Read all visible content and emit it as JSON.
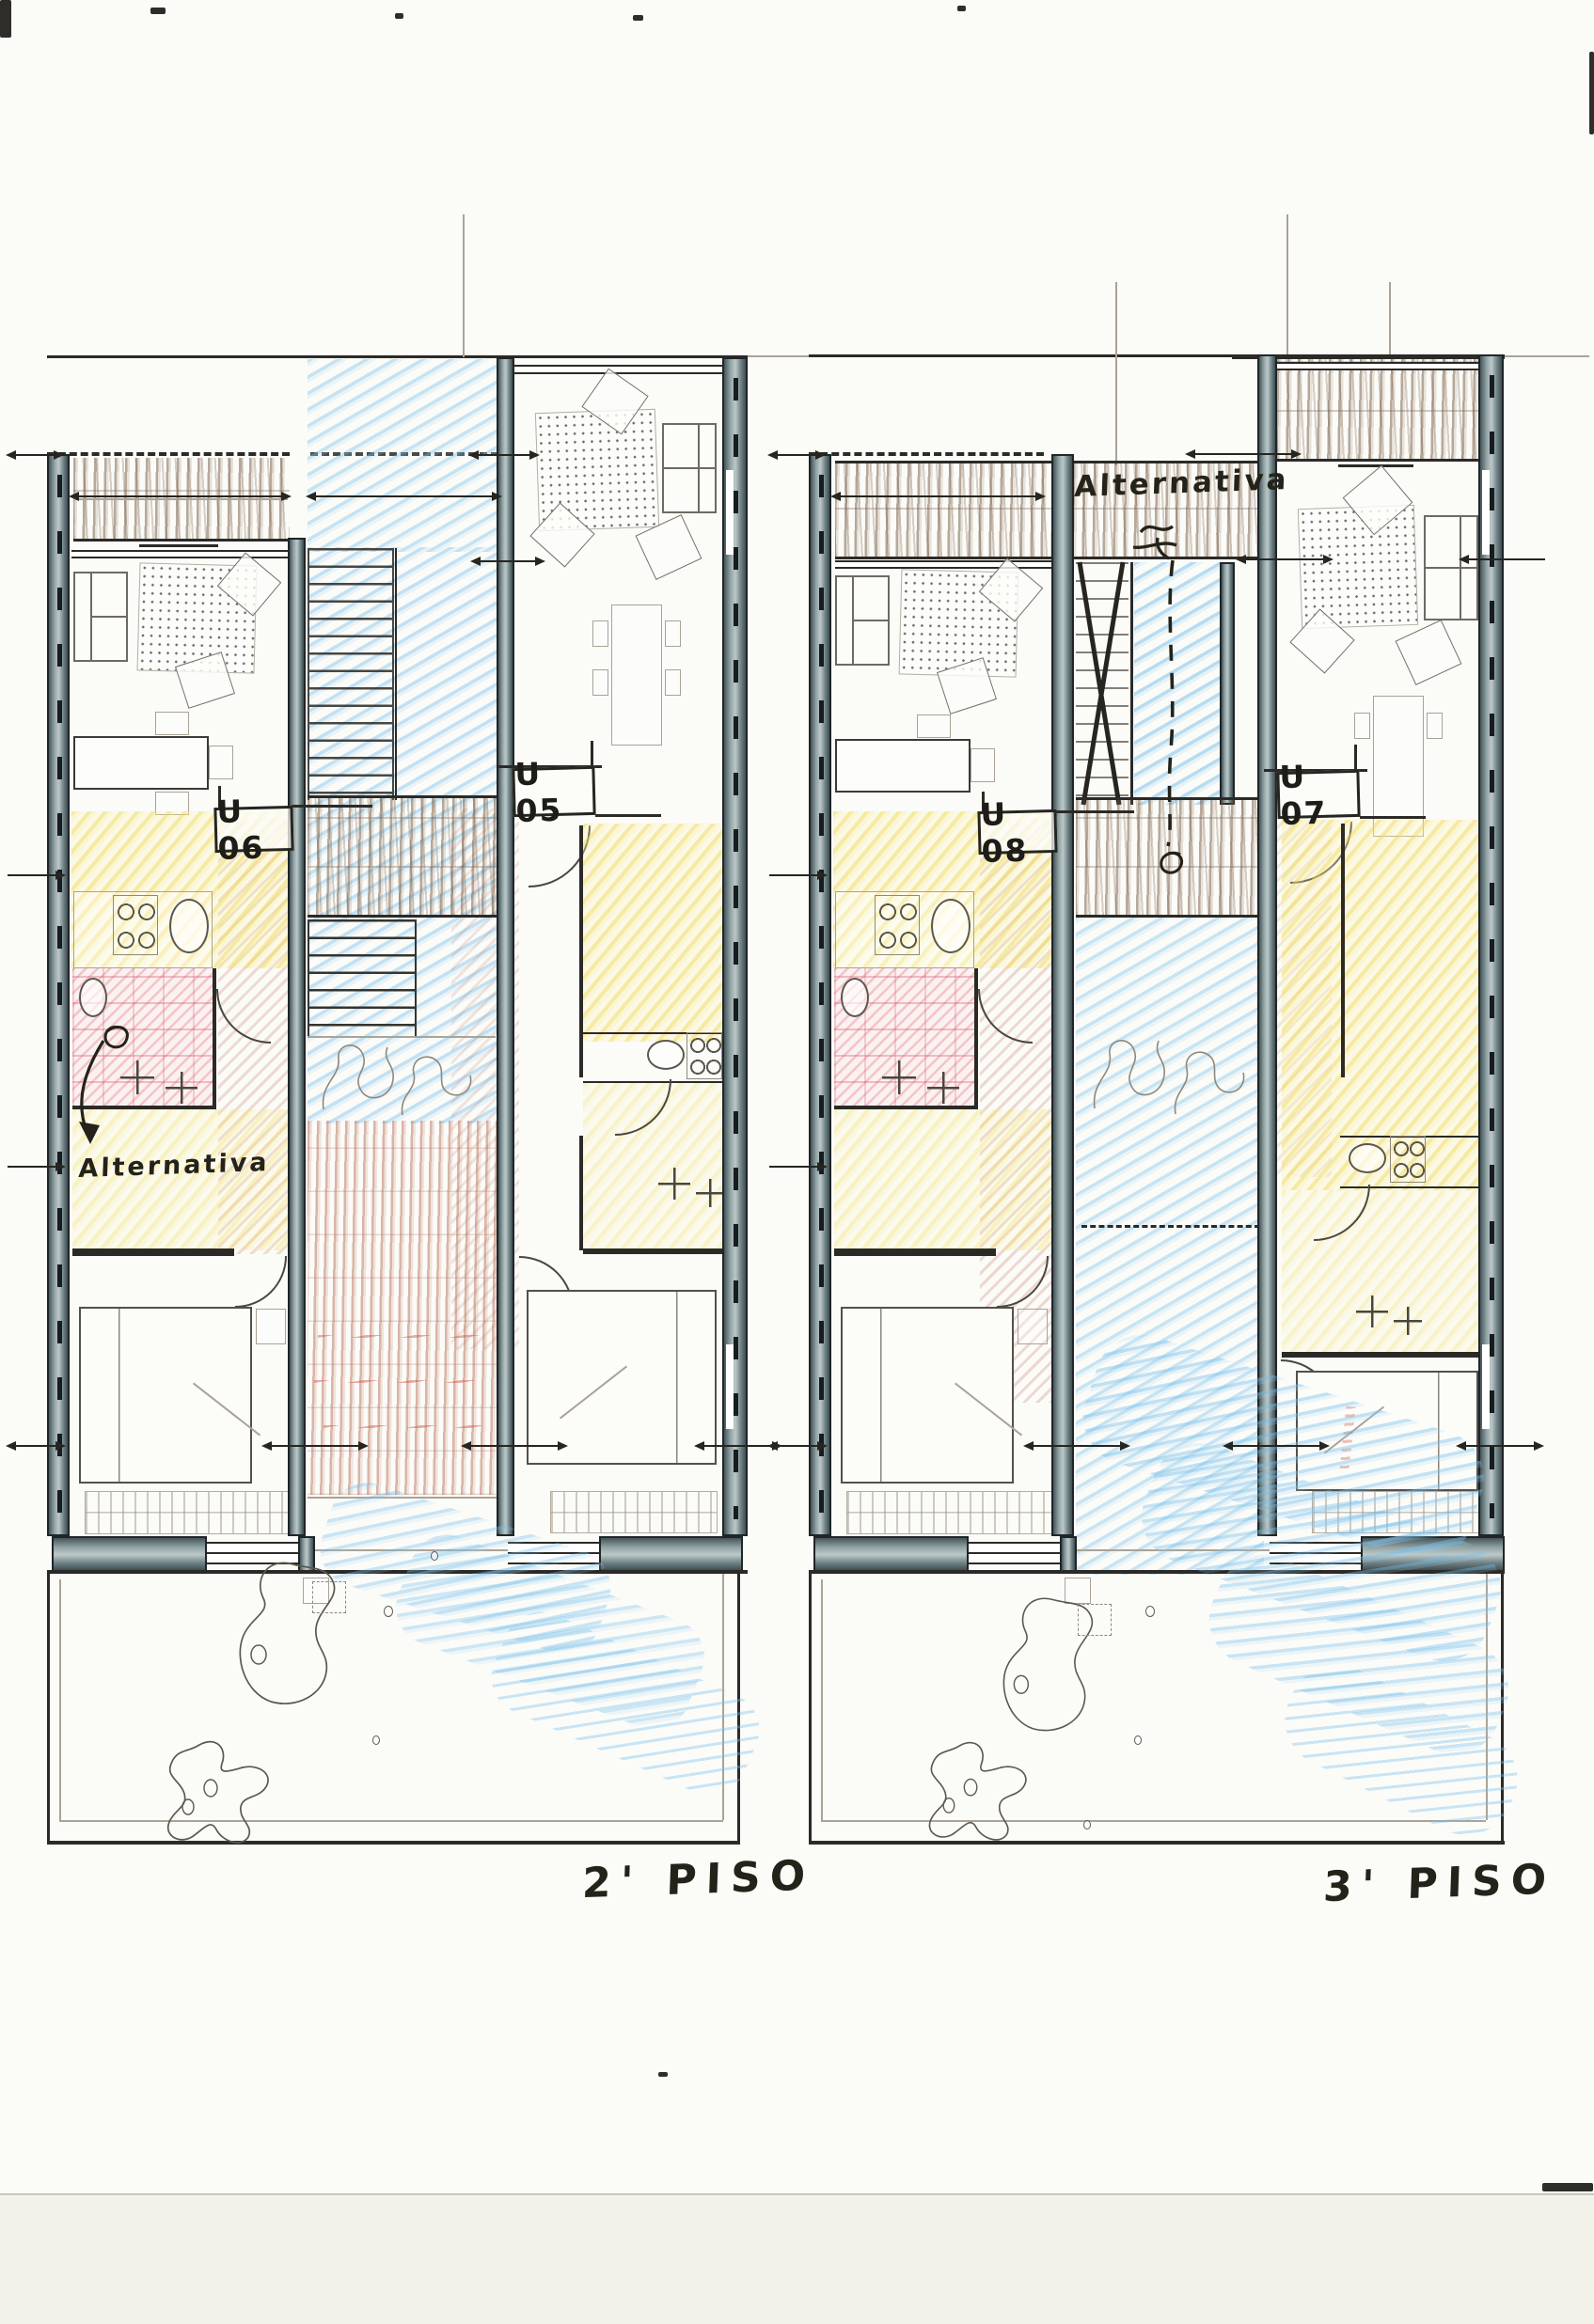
{
  "document": {
    "type": "hand-drawn architectural floor plan sketch",
    "sheet_background": "#fbfbf8",
    "scan_background": "#f2f1ea"
  },
  "plans": [
    {
      "caption": "2' PISO",
      "unit_left_label": "U 06",
      "unit_right_label": "U 05",
      "annotation": "Alternativa",
      "annotation_position": "lower-left room with curved arrow"
    },
    {
      "caption": "3' PISO",
      "unit_left_label": "U 08",
      "unit_right_label": "U 07",
      "annotation": "Alternativa",
      "annotation_position": "top deck with dashed arrow to stair"
    }
  ],
  "colors": {
    "ink": "#2b2a26",
    "pencil": "#aaa396",
    "wall_poche": "#6e8185",
    "deck_brown": "#70573f",
    "terracotta": "#ad6048",
    "crayon_blue": "#78c0ec",
    "crayon_yellow": "#f0da58",
    "crayon_pink": "#d53e54"
  }
}
